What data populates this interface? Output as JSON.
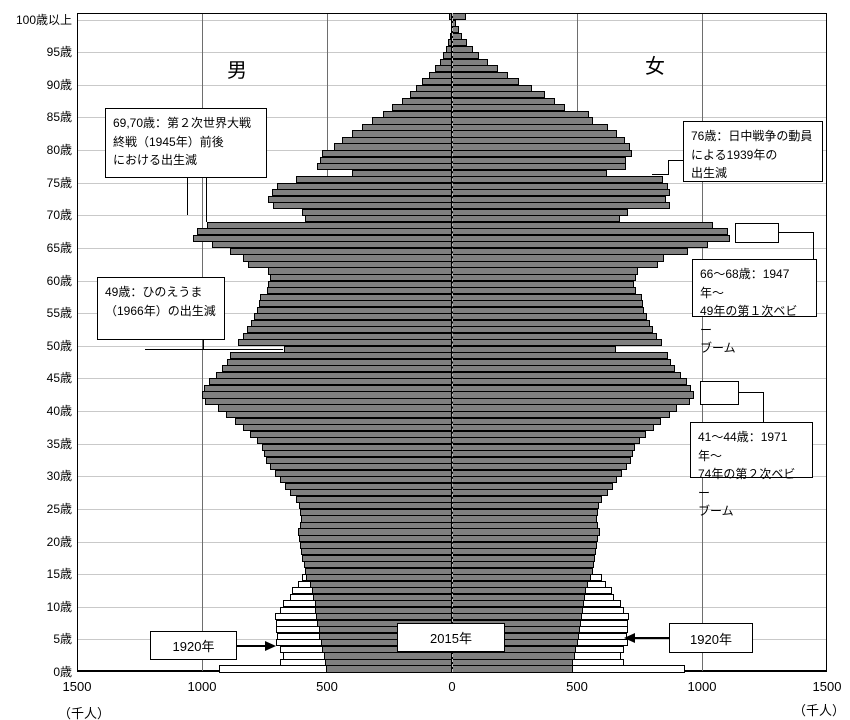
{
  "header": {
    "male_label": "男",
    "female_label": "女"
  },
  "axis": {
    "unit_left": "（千人）",
    "unit_right": "（千人）",
    "x_tick_labels": [
      "1500",
      "1000",
      "500",
      "0",
      "500",
      "1000",
      "1500"
    ],
    "age_tick_labels": [
      "0歳",
      "5歳",
      "10歳",
      "15歳",
      "20歳",
      "25歳",
      "30歳",
      "35歳",
      "40歳",
      "45歳",
      "50歳",
      "55歳",
      "60歳",
      "65歳",
      "70歳",
      "75歳",
      "80歳",
      "85歳",
      "90歳",
      "95歳",
      "100歳以上"
    ]
  },
  "year_callouts": {
    "left_1920": "1920年",
    "center_2015": "2015年",
    "right_1920": "1920年"
  },
  "chart_data": {
    "type": "bar",
    "subtype": "population-pyramid",
    "title": "人口ピラミッド（2015年・1920年）",
    "unit": "千人",
    "x_axis_max_each_side": 1500,
    "age_range": "0〜100歳以上（1歳刻み）",
    "grid": "on",
    "series": [
      {
        "name": "2015年 男",
        "side": "left",
        "style": "dark",
        "values": [
          505,
          508,
          514,
          519,
          526,
          531,
          534,
          541,
          544,
          548,
          550,
          556,
          561,
          570,
          583,
          590,
          594,
          599,
          603,
          608,
          612,
          618,
          610,
          606,
          608,
          612,
          625,
          648,
          668,
          688,
          708,
          730,
          746,
          752,
          760,
          780,
          808,
          838,
          868,
          904,
          936,
          988,
          1002,
          992,
          974,
          946,
          922,
          902,
          888,
          672,
          858,
          838,
          820,
          804,
          792,
          780,
          772,
          768,
          742,
          736,
          728,
          736,
          816,
          836,
          888,
          960,
          1036,
          1020,
          980,
          588,
          600,
          716,
          736,
          720,
          700,
          624,
          400,
          540,
          528,
          520,
          472,
          440,
          400,
          360,
          320,
          276,
          240,
          200,
          170,
          145,
          120,
          92,
          70,
          50,
          36,
          25,
          16,
          10,
          6,
          4,
          14
        ]
      },
      {
        "name": "2015年 女",
        "side": "right",
        "style": "dark",
        "values": [
          482,
          485,
          491,
          496,
          502,
          507,
          510,
          517,
          520,
          524,
          526,
          531,
          536,
          544,
          556,
          562,
          566,
          571,
          575,
          580,
          584,
          590,
          583,
          580,
          583,
          588,
          600,
          622,
          642,
          661,
          680,
          701,
          716,
          722,
          730,
          750,
          777,
          806,
          836,
          870,
          900,
          952,
          966,
          956,
          940,
          914,
          892,
          874,
          862,
          656,
          838,
          820,
          804,
          790,
          778,
          768,
          762,
          758,
          734,
          728,
          736,
          744,
          824,
          848,
          944,
          1024,
          1112,
          1104,
          1044,
          672,
          704,
          872,
          856,
          872,
          864,
          844,
          620,
          696,
          696,
          720,
          712,
          692,
          660,
          624,
          564,
          548,
          452,
          412,
          370,
          318,
          268,
          222,
          182,
          143,
          109,
          82,
          58,
          40,
          26,
          16,
          55
        ]
      },
      {
        "name": "1920年 男",
        "side": "left",
        "style": "white-outline",
        "values": [
          932,
          690,
          678,
          690,
          706,
          700,
          706,
          704,
          708,
          688,
          676,
          648,
          640,
          618,
          600
        ]
      },
      {
        "name": "1920年 女",
        "side": "right",
        "style": "white-outline",
        "values": [
          930,
          688,
          676,
          688,
          704,
          698,
          704,
          702,
          706,
          686,
          674,
          646,
          638,
          616,
          598
        ]
      }
    ],
    "annotations": [
      {
        "id": "ww2-end",
        "text": "69,70歳：第２次世界大戦\n終戦（1945年）前後\nにおける出生減",
        "box": [
          105,
          108,
          162,
          70
        ],
        "lines": [
          [
            187,
            178,
            187,
            215
          ],
          [
            206,
            178,
            206,
            222
          ]
        ]
      },
      {
        "id": "hinoeuma",
        "text": "49歳：ひのえうま\n（1966年）の出生減",
        "box": [
          97,
          277,
          128,
          63
        ],
        "lines": [
          [
            203,
            340,
            203,
            349
          ],
          [
            145,
            349,
            283,
            349
          ]
        ]
      },
      {
        "id": "dip-1939",
        "text": "76歳：日中戦争の動員\nによる1939年の\n出生減",
        "box": [
          683,
          121,
          140,
          61
        ],
        "lines": [
          [
            668,
            160,
            683,
            160
          ],
          [
            668,
            160,
            668,
            175
          ],
          [
            652,
            174,
            668,
            174
          ]
        ]
      },
      {
        "id": "baby-boom-1",
        "text": "66〜68歳：1947年〜\n49年の第１次ベビー\nブーム",
        "box": [
          692,
          259,
          125,
          58
        ],
        "rect": [
          735,
          223,
          44,
          20
        ],
        "lines": [
          [
            779,
            232,
            813,
            232
          ],
          [
            813,
            232,
            813,
            259
          ]
        ]
      },
      {
        "id": "baby-boom-2",
        "text": "41〜44歳：1971年〜\n74年の第２次ベビー\nブーム",
        "box": [
          690,
          422,
          123,
          56
        ],
        "rect": [
          700,
          381,
          39,
          24
        ],
        "lines": [
          [
            739,
            392,
            763,
            392
          ],
          [
            763,
            392,
            763,
            422
          ]
        ]
      }
    ]
  }
}
